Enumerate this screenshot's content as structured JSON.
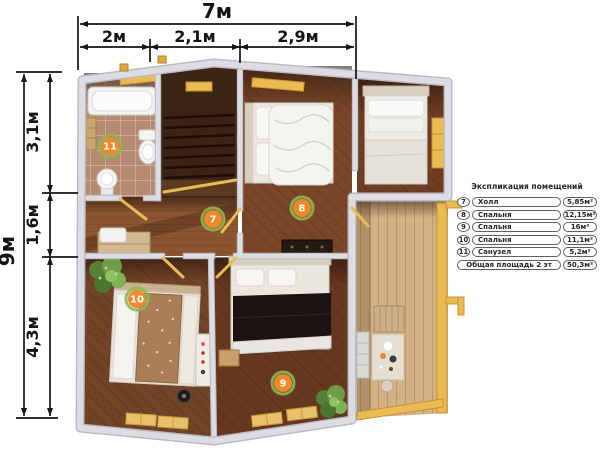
{
  "dimensions": {
    "top": {
      "total": "7м",
      "segments": [
        "2м",
        "2,1м",
        "2,9м"
      ]
    },
    "left": {
      "total": "9м",
      "segments": [
        "3,1м",
        "1,6м",
        "4,3м"
      ]
    }
  },
  "plan": {
    "badges": {
      "hall": "7",
      "bedroom8": "8",
      "bedroom9": "9",
      "bedroom10": "10",
      "bathroom": "11"
    }
  },
  "legend": {
    "title": "Экспликация помещений",
    "rows": [
      {
        "num": "7",
        "name": "Холл",
        "area": "5,85м²"
      },
      {
        "num": "8",
        "name": "Спальня",
        "area": "12,15м²"
      },
      {
        "num": "9",
        "name": "Спальня",
        "area": "16м²"
      },
      {
        "num": "10",
        "name": "Спальня",
        "area": "11,1м²"
      },
      {
        "num": "11",
        "name": "Санузел",
        "area": "5,2м²"
      }
    ],
    "total": {
      "name": "Общая площадь 2 эт",
      "area": "50,3м²"
    }
  },
  "colors": {
    "badge": "#EE8A2B",
    "badge_ring": "#8CB852",
    "accent_yellow": "#E9BC52",
    "wall": "#D8D8DE",
    "dimension_ink": "#141414"
  }
}
